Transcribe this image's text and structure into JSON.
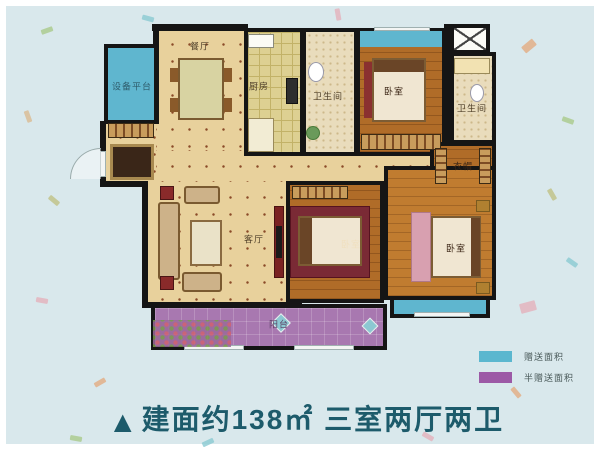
{
  "plan": {
    "rooms": {
      "equipment_platform": "设备平台",
      "dining": "餐厅",
      "kitchen": "厨房",
      "bathroom_top": "卫生间",
      "bedroom_top": "卧室",
      "bathroom_right": "卫生间",
      "cloakroom": "衣帽",
      "living": "客厅",
      "bedroom_middle": "卧室",
      "bedroom_master": "卧室",
      "balcony": "阳台"
    }
  },
  "legend": {
    "items": [
      {
        "label": "赠送面积",
        "color": "#5bb7cf"
      },
      {
        "label": "半赠送面积",
        "color": "#9c59a6"
      }
    ]
  },
  "caption": {
    "marker": "▲",
    "text": "建面约138㎡ 三室两厅两卫"
  },
  "colors": {
    "background": "#d9e8ec",
    "gift_area": "#5bb7cf",
    "half_gift_area": "#9c59a6",
    "caption_text": "#1d5b6b",
    "walls": "#151515",
    "hall_floor": "#e8d19c",
    "wood_floor": "#b06c28"
  }
}
